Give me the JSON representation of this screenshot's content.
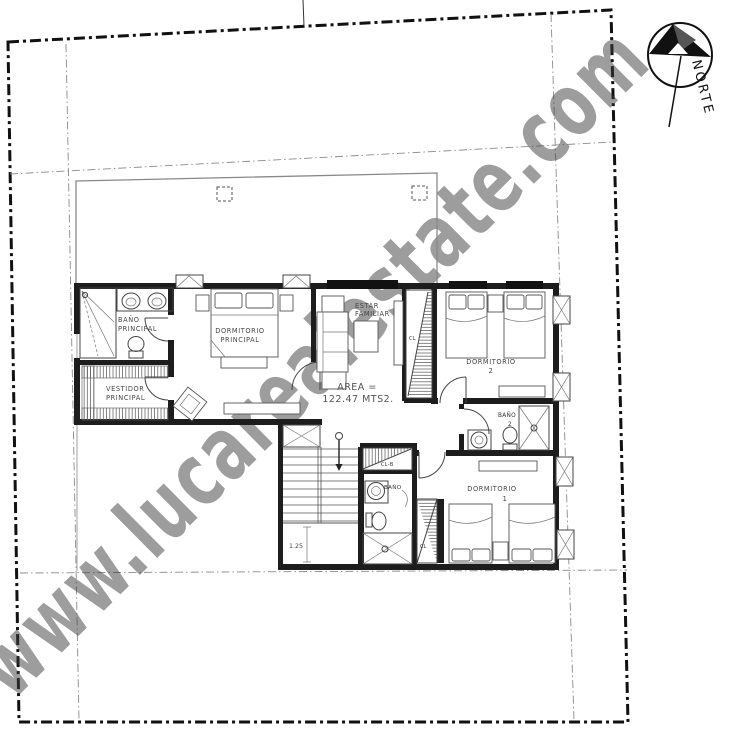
{
  "watermark": {
    "text": "www.lucarealestate.com"
  },
  "compass": {
    "north_label": "NORTE"
  },
  "annotations": {
    "area_label": "AREA =",
    "area_value": "122.47 MTS2.",
    "stair_dimension": "1.25"
  },
  "rooms": {
    "bano_principal": {
      "line1": "BAÑO",
      "line2": "PRINCIPAL"
    },
    "vestidor_principal": {
      "line1": "VESTIDOR",
      "line2": "PRINCIPAL"
    },
    "dormitorio_principal": {
      "line1": "DORMITORIO",
      "line2": "PRINCIPAL"
    },
    "estar_familiar": {
      "line1": "ESTAR",
      "line2": "FAMILIAR"
    },
    "dormitorio_2": {
      "line1": "DORMITORIO",
      "line2": "2"
    },
    "bano_2": {
      "line1": "BAÑO",
      "line2": "2"
    },
    "dormitorio_1": {
      "line1": "DORMITORIO",
      "line2": "1"
    },
    "bano_3": {
      "line1": "BAÑO"
    },
    "closet_hall": {
      "label": "CL"
    },
    "closet_linen": {
      "label": "CL-B"
    },
    "closet_dorm1": {
      "label": "CL"
    }
  },
  "colors": {
    "boundary": "#111111",
    "setback": "#8a8a8a",
    "wall": "#1d1d1d",
    "watermark": "#b2b2b2"
  }
}
